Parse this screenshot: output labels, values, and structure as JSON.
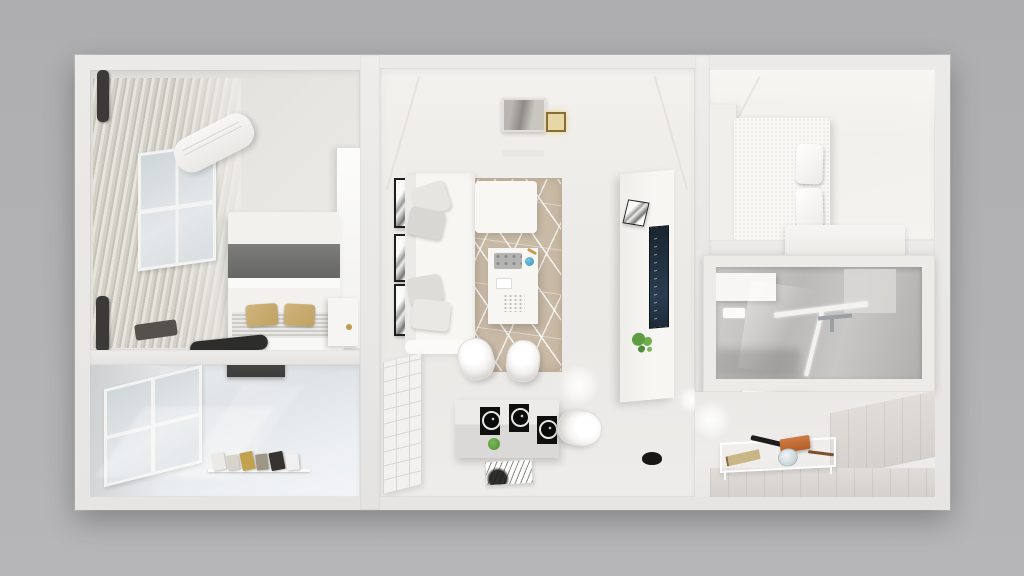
{
  "scene": {
    "type": "3d-floorplan-render",
    "description": "Top-down dollhouse cutaway render of a one-bedroom apartment in white, gray and beige tones",
    "view": "top-down 3D cutaway",
    "background_color": "#b1b1b3",
    "wall_color": "#e9e8e6"
  },
  "palette": {
    "floor_light": "#edecea",
    "wall_face": "#f1efec",
    "rug_beige": "#c9baa6",
    "rug_lines": "#ffffff",
    "sofa_white": "#f6f5f2",
    "blanket_gray": "#6f6f6d",
    "pillow_gold": "#c7a96e",
    "tv_screen_navy": "#1d2b39",
    "plant_green": "#6fae4e",
    "marble_gray": "#c0bebc",
    "glass_blue": "#d4dbde",
    "accent_orange": "#c4703d",
    "curtain_taupe": "#d2cfc6",
    "dark_object": "#2d2d2b"
  },
  "rooms": [
    {
      "id": "bedroom-left",
      "label": "Master bedroom",
      "items": [
        "pleated curtains",
        "curtain rod caps",
        "window",
        "air conditioner",
        "double bed",
        "gray blanket",
        "gold pillows",
        "striped sheet",
        "nightstand",
        "dark floor runner",
        "mirror panel",
        "floor bag"
      ]
    },
    {
      "id": "utility-room",
      "label": "Utility room / balcony",
      "items": [
        "marble side wall",
        "grid window",
        "glossy reflective floor",
        "dark wall cabinet",
        "row of storage boxes"
      ]
    },
    {
      "id": "living-room",
      "label": "Living room",
      "items": [
        "gallery wall frames",
        "sectional sofa",
        "chaise module",
        "throw pillows",
        "geometric area rug",
        "coffee table",
        "serving tray",
        "teal ornament",
        "notepad",
        "tv wall unit",
        "tv screen",
        "leaning art frame",
        "green plant",
        "cube shelving unit",
        "dining table",
        "black place settings",
        "dining chairs",
        "black floor bowl",
        "sketch doormat",
        "ceiling picture",
        "brass ceiling lamp",
        "ceiling light orbs",
        "air vent"
      ]
    },
    {
      "id": "bedroom-right",
      "label": "Small bedroom",
      "items": [
        "wardrobe panel",
        "double bed",
        "white pillows",
        "dresser sideboard"
      ]
    },
    {
      "id": "bathroom",
      "label": "Bathroom",
      "items": [
        "vanity cabinet",
        "paper roll holder",
        "glass shower enclosure",
        "chrome faucet",
        "marble walls",
        "floating shelf"
      ]
    },
    {
      "id": "entry-hall",
      "label": "Entry hall",
      "items": [
        "wainscot paneling",
        "clear console table",
        "tan notebook",
        "black umbrella",
        "orange clutch",
        "glass vase",
        "brown pen",
        "floor light glow"
      ]
    }
  ]
}
